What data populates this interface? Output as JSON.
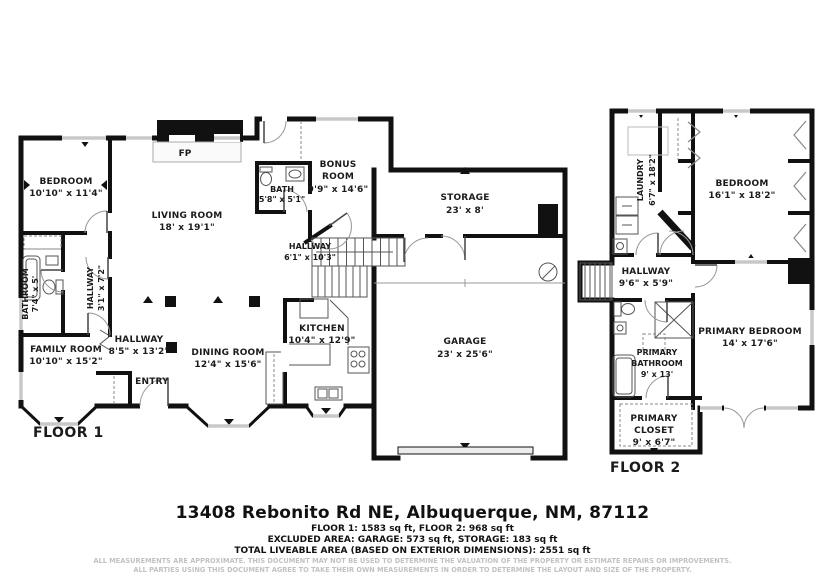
{
  "floor1": {
    "label": "FLOOR 1",
    "fireplace": "FP",
    "rooms": {
      "bedroom": {
        "name": "BEDROOM",
        "dims": "10'10\" x 11'4\""
      },
      "living": {
        "name": "LIVING ROOM",
        "dims": "18' x 19'1\""
      },
      "bathroom": {
        "name": "BATHROOM",
        "dims": "7'4\" x 5'"
      },
      "hallway_bath": {
        "name": "HALLWAY",
        "dims": "3'1\" x 7'2\""
      },
      "bath": {
        "name": "BATH",
        "dims": "5'8\" x 5'1\""
      },
      "bonus": {
        "line1": "BONUS",
        "line2": "ROOM",
        "dims": "9'9\" x 14'6\""
      },
      "hallway_center": {
        "name": "HALLWAY",
        "dims": "6'1\" x 10'3\""
      },
      "storage": {
        "name": "STORAGE",
        "dims": "23' x 8'"
      },
      "garage": {
        "name": "GARAGE",
        "dims": "23' x 25'6\""
      },
      "kitchen": {
        "name": "KITCHEN",
        "dims": "10'4\" x 12'9\""
      },
      "dining": {
        "name": "DINING ROOM",
        "dims": "12'4\" x 15'6\""
      },
      "family": {
        "name": "FAMILY ROOM",
        "dims": "10'10\" x 15'2\""
      },
      "hallway_entry": {
        "name": "HALLWAY",
        "dims": "8'5\" x 13'2\""
      },
      "entry": {
        "name": "ENTRY"
      }
    }
  },
  "floor2": {
    "label": "FLOOR 2",
    "rooms": {
      "laundry": {
        "name": "LAUNDRY",
        "dims": "6'7\" x 18'2\""
      },
      "bedroom": {
        "name": "BEDROOM",
        "dims": "16'1\" x 18'2\""
      },
      "hallway": {
        "name": "HALLWAY",
        "dims": "9'6\" x 5'9\""
      },
      "primary_bedroom": {
        "name": "PRIMARY BEDROOM",
        "dims": "14' x 17'6\""
      },
      "primary_bathroom": {
        "line1": "PRIMARY",
        "line2": "BATHROOM",
        "dims": "9' x 13'"
      },
      "primary_closet": {
        "line1": "PRIMARY",
        "line2": "CLOSET",
        "dims": "9' x 6'7\""
      }
    }
  },
  "footer": {
    "address": "13408 Rebonito Rd NE, Albuquerque, NM, 87112",
    "areas_line1": "FLOOR 1: 1583 sq ft, FLOOR 2: 968 sq ft",
    "areas_line2": "EXCLUDED AREA: GARAGE: 573 sq ft, STORAGE: 183 sq ft",
    "areas_line3": "TOTAL LIVEABLE AREA (BASED ON EXTERIOR DIMENSIONS): 2551 sq ft",
    "disclaimer1": "ALL MEASUREMENTS ARE APPROXIMATE. THIS DOCUMENT MAY NOT BE USED TO DETERMINE THE VALUATION OF THE PROPERTY OR ESTIMATE REPAIRS OR IMPROVEMENTS.",
    "disclaimer2": "ALL PARTIES USING THIS DOCUMENT AGREE TO TAKE THEIR OWN MEASUREMENTS IN ORDER TO DETERMINE THE LAYOUT AND SIZE OF THE PROPERTY."
  }
}
